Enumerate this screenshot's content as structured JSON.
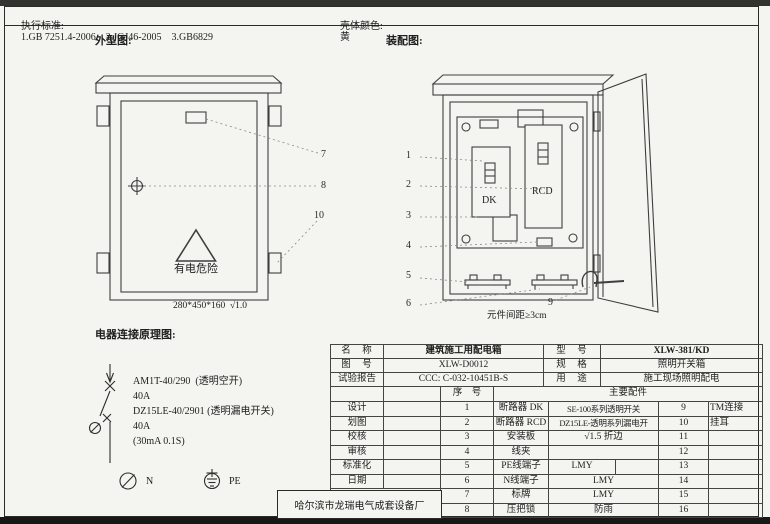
{
  "header": {
    "standards_label": "执行标准:",
    "standards": "1.GB 7251.4-2006    2.JGJ46-2005    3.GB6829",
    "shell_color_label": "壳体颜色:",
    "shell_color": "黄"
  },
  "sections": {
    "outline": "外型图:",
    "assembly": "装配图:",
    "schematic": "电器连接原理图:"
  },
  "outline": {
    "warning_text": "有电危险",
    "dimension": "280*450*160  √1.0",
    "callouts": [
      "7",
      "8",
      "10"
    ]
  },
  "assembly": {
    "dk_label": "DK",
    "rcd_label": "RCD",
    "callouts": [
      "1",
      "2",
      "3",
      "4",
      "5",
      "6"
    ],
    "callout9": "9",
    "note": "元件间距≥3cm"
  },
  "schematic": {
    "lines": [
      "AM1T-40/290  (透明空开)",
      "40A",
      "DZ15LE-40/2901 (透明漏电开关)",
      "40A",
      "(30mA 0.1S)"
    ],
    "n_label": "N",
    "pe_label": "PE"
  },
  "info_table": {
    "name_label": "名　称",
    "name_value": "建筑施工用配电箱",
    "model_label": "型　号",
    "model_value": "XLW-381/KD",
    "drawing_no_label": "图　号",
    "drawing_no_value": "XLW-D0012",
    "spec_label": "规　格",
    "spec_value": "照明开关箱",
    "report_label": "试验报告",
    "report_value": "CCC: C-032-10451B-S",
    "use_label": "用　途",
    "use_value": "施工现场照明配电",
    "serial_header": "序　号",
    "parts_header": "主要配件",
    "signoff": [
      "设计",
      "划图",
      "校核",
      "审核",
      "标准化",
      "日期"
    ],
    "items": [
      {
        "no": "1",
        "name": "断路器 DK",
        "spec": "SE-100系列透明开关",
        "no2": "9",
        "spec2": "TM连接"
      },
      {
        "no": "2",
        "name": "断路器 RCD",
        "spec": "DZ15LE-透明系列漏电开",
        "no2": "10",
        "spec2": "挂耳"
      },
      {
        "no": "3",
        "name": "安装板",
        "spec": "√1.5 折边",
        "no2": "11",
        "spec2": ""
      },
      {
        "no": "4",
        "name": "线夹",
        "spec": "",
        "no2": "12",
        "spec2": ""
      },
      {
        "no": "5",
        "name": "PE线端子",
        "spec": "LMY",
        "no2": "13",
        "spec2": ""
      },
      {
        "no": "6",
        "name": "N线端子",
        "spec": "LMY",
        "no2": "14",
        "spec2": ""
      },
      {
        "no": "7",
        "name": "标牌",
        "spec": "LMY",
        "no2": "15",
        "spec2": ""
      },
      {
        "no": "8",
        "name": "压把锁",
        "spec": "防雨",
        "no2": "16",
        "spec2": ""
      }
    ],
    "company": "哈尔滨市龙瑞电气成套设备厂"
  },
  "colors": {
    "paper": "#f4f4f1",
    "ink": "#2a2a28",
    "shell_color_value": "黄"
  }
}
